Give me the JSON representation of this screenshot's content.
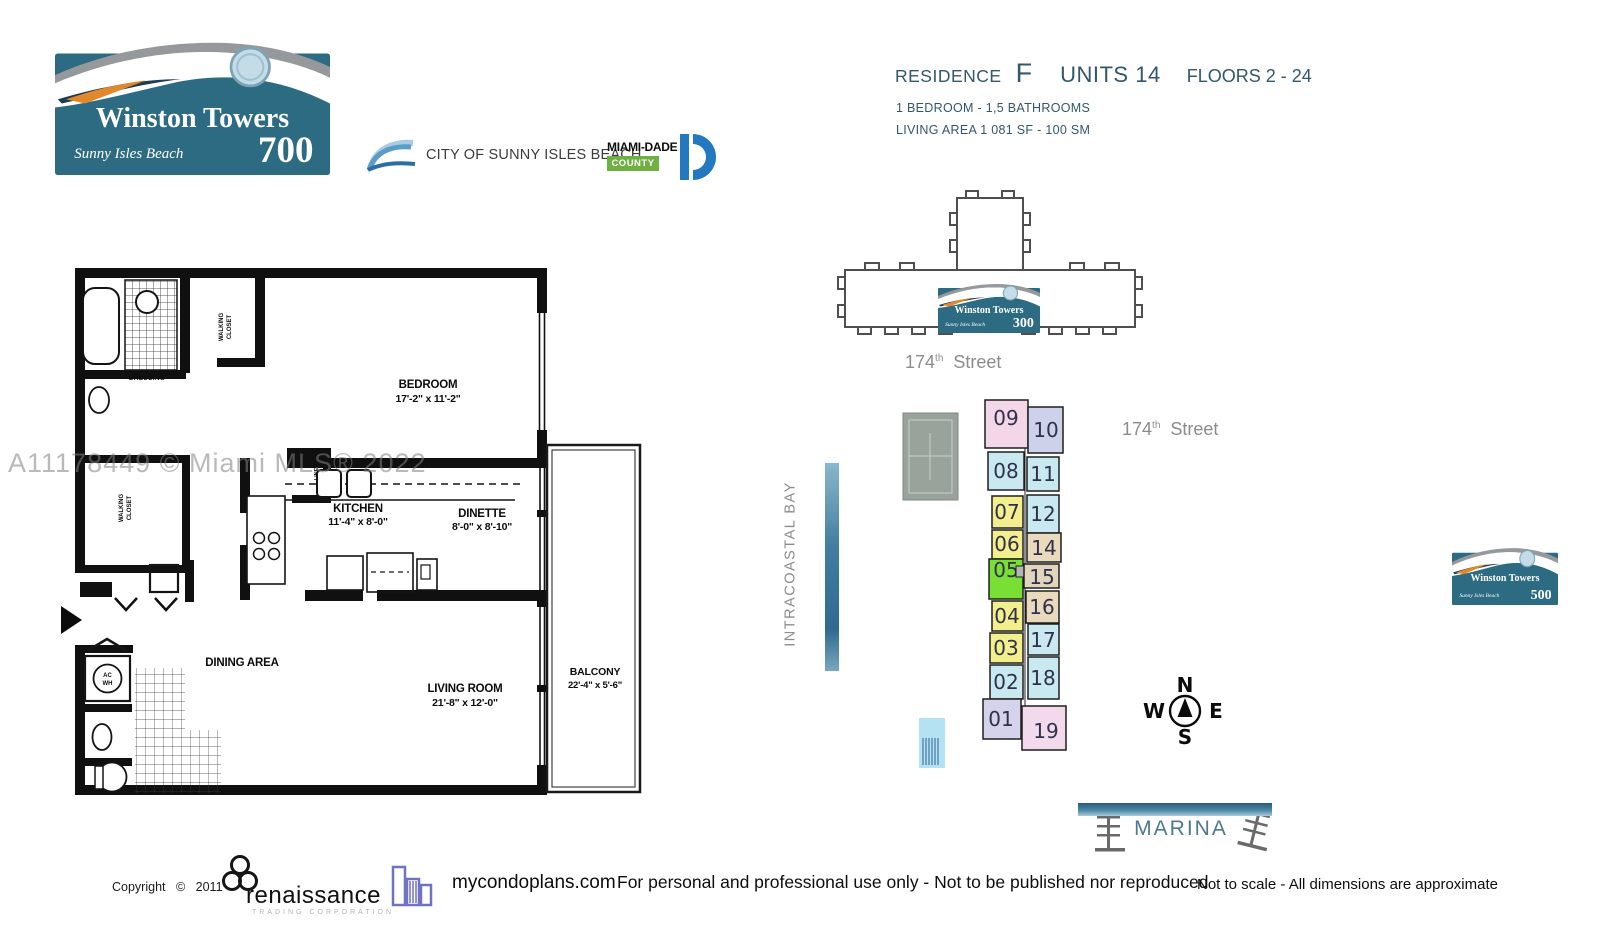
{
  "header": {
    "logo_700": {
      "title": "Winston Towers",
      "subtitle": "Sunny Isles Beach",
      "number": "700"
    },
    "city_logo": {
      "label": "CITY OF SUNNY ISLES BEACH"
    },
    "county_logo": {
      "name": "MIAMI-DADE",
      "county": "COUNTY"
    },
    "residence_title": {
      "residence_label": "RESIDENCE",
      "residence_letter": "F",
      "units_label": "UNITS 14",
      "floors_label": "FLOORS 2 - 24"
    },
    "residence_specs": {
      "bedrooms": "1 BEDROOM - 1,5 BATHROOMS",
      "living_area": "LIVING AREA  1 081 SF - 100 SM"
    }
  },
  "floorplan": {
    "watermark": "A11178449 © Miami MLS® 2022",
    "bedroom": {
      "name": "BEDROOM",
      "dims": "17'-2\" x 11'-2\""
    },
    "kitchen": {
      "name": "KITCHEN",
      "dims": "11'-4\" x 8'-0\""
    },
    "dinette": {
      "name": "DINETTE",
      "dims": "8'-0\" x 8'-10\""
    },
    "living_room": {
      "name": "LIVING ROOM",
      "dims": "21'-8\" x 12'-0\""
    },
    "dining_area": {
      "name": "DINING AREA"
    },
    "balcony": {
      "name": "BALCONY",
      "dims": "22'-4\" x 5'-6\""
    },
    "dressing": {
      "name": "DRESSING"
    },
    "walking_closet_1": {
      "line1": "WALKING",
      "line2": "CLOSET"
    },
    "walking_closet_2": {
      "line1": "WALKING",
      "line2": "CLOSET"
    },
    "linen": {
      "name": "LINEN"
    },
    "ac_wh": {
      "line1": "AC",
      "line2": "WH"
    }
  },
  "siteplan": {
    "building_300_logo": {
      "title": "Winston Towers",
      "subtitle": "Sunny Isles Beach",
      "number": "300"
    },
    "street_north": {
      "number": "174",
      "sup": "th",
      "word": "Street"
    },
    "street_east": {
      "number": "174",
      "sup": "th",
      "word": "Street"
    },
    "bay_label": "INTRACOASTAL BAY",
    "marina_label": "MARINA",
    "compass": {
      "north": "N",
      "south": "S",
      "east": "E",
      "west": "W"
    },
    "units": [
      {
        "label": "09",
        "color": "#f3d6e7"
      },
      {
        "label": "08",
        "color": "#c9e9f1"
      },
      {
        "label": "07",
        "color": "#f4ef8d"
      },
      {
        "label": "06",
        "color": "#f4ef8d"
      },
      {
        "label": "05",
        "color": "#7adf35"
      },
      {
        "label": "04",
        "color": "#f4ef8d"
      },
      {
        "label": "03",
        "color": "#f4ef8d"
      },
      {
        "label": "02",
        "color": "#c9e9f1"
      },
      {
        "label": "01",
        "color": "#d5d2ec"
      },
      {
        "label": "10",
        "color": "#cdd1e9"
      },
      {
        "label": "11",
        "color": "#c9e9f1"
      },
      {
        "label": "12",
        "color": "#c9e9f1"
      },
      {
        "label": "14",
        "color": "#e9d9bd"
      },
      {
        "label": "15",
        "color": "#e2d5bd"
      },
      {
        "label": "16",
        "color": "#e9d9bd"
      },
      {
        "label": "17",
        "color": "#c9e9f1"
      },
      {
        "label": "18",
        "color": "#c9e9f1"
      },
      {
        "label": "19",
        "color": "#f3d9ec"
      }
    ]
  },
  "logo_500": {
    "title": "Winston Towers",
    "subtitle": "Sunny Isles Beach",
    "number": "500"
  },
  "footer": {
    "copyright": "Copyright © 2011",
    "renaissance": {
      "name": "renaissance",
      "tagline": "TRADING CORPORATION"
    },
    "mycondoplans": "mycondoplans.com",
    "disclaimer_center": "For personal and professional use only - Not to be published nor reproduced",
    "disclaimer_right": "Not to scale - All dimensions are approximate"
  }
}
